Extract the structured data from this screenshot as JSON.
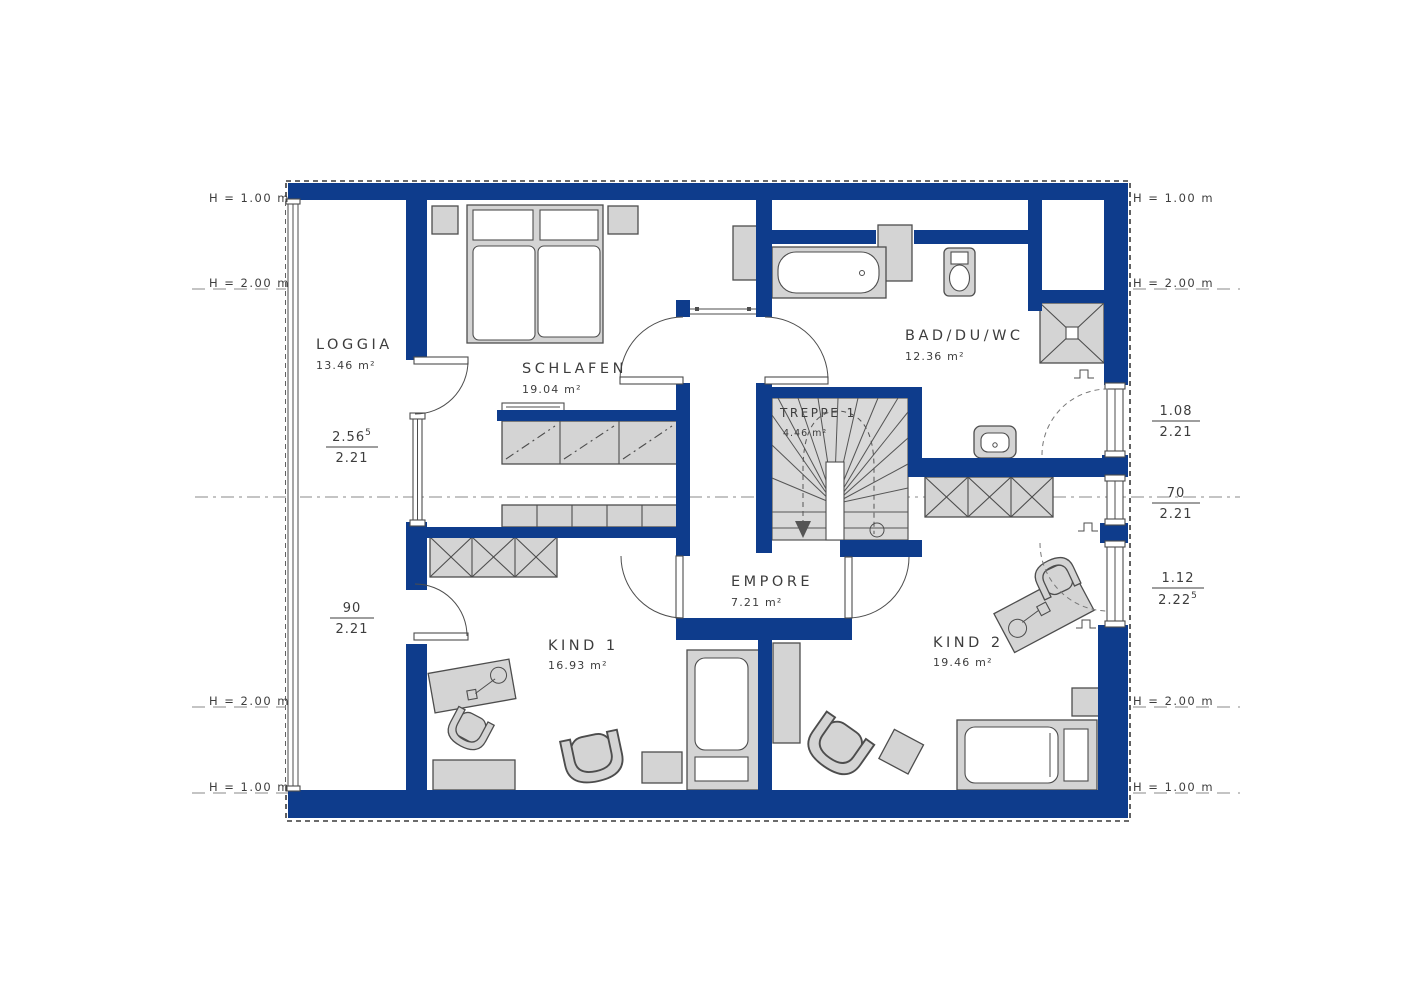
{
  "plan": {
    "colors": {
      "wall": "#0e3c8c",
      "furniture": "#d4d4d4",
      "line": "#4d4d4d"
    },
    "rooms": {
      "loggia": {
        "name": "LOGGIA",
        "area": "13.46 m²"
      },
      "schlafen": {
        "name": "SCHLAFEN",
        "area": "19.04 m²"
      },
      "bad": {
        "name": "BAD/DU/WC",
        "area": "12.36 m²"
      },
      "treppe": {
        "name": "TREPPE 1",
        "area": "4.46 m²"
      },
      "empore": {
        "name": "EMPORE",
        "area": "7.21 m²"
      },
      "kind1": {
        "name": "KIND 1",
        "area": "16.93 m²"
      },
      "kind2": {
        "name": "KIND 2",
        "area": "19.46 m²"
      }
    },
    "height_marks": {
      "top_left": "H = 1.00 m",
      "upper_left": "H = 2.00 m",
      "lower_left": "H = 2.00 m",
      "bottom_left": "H = 1.00 m",
      "top_right": "H = 1.00 m",
      "upper_right": "H = 2.00 m",
      "lower_right": "H = 2.00 m",
      "bottom_right": "H = 1.00 m"
    },
    "dimensions": {
      "left_window": {
        "num": "2.56",
        "num_sup": "5",
        "den": "2.21"
      },
      "left_door": {
        "num": "90",
        "den": "2.21"
      },
      "right_window_top": {
        "num": "1.08",
        "den": "2.21"
      },
      "right_window_mid": {
        "num": "70",
        "den": "2.21"
      },
      "right_window_bottom": {
        "num": "1.12",
        "den": "2.22",
        "den_sup": "5"
      }
    }
  }
}
